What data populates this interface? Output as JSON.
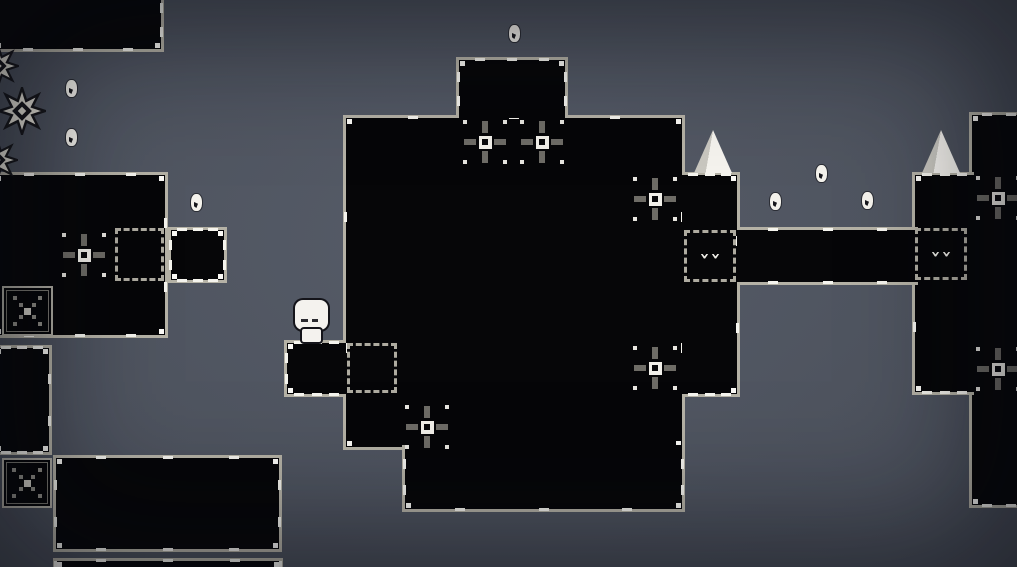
{
  "scene": {
    "width": 1017,
    "height": 567,
    "colors": {
      "background_center": "#565c68",
      "background_edge": "#3b3f49",
      "platform_fill": "#060608",
      "platform_border": "#b5b2a6",
      "tick_white": "#f5f4ee",
      "sprite_white": "#f4f2ec",
      "target_gray": "#6e6c66"
    }
  },
  "entities": {
    "player": {
      "x": 295,
      "y": 300,
      "description": "white blob character with two dark eyes standing on ledge"
    },
    "platforms": [
      {
        "name": "platform-top-left",
        "x": -8,
        "y": -12,
        "w": 172,
        "h": 64,
        "border": "1111"
      },
      {
        "name": "platform-left-mid",
        "x": -8,
        "y": 172,
        "w": 176,
        "h": 166,
        "border": "1111"
      },
      {
        "name": "platform-left-extension",
        "x": 168,
        "y": 227,
        "w": 59,
        "h": 56,
        "border": "1111"
      },
      {
        "name": "platform-left-vertical",
        "x": -8,
        "y": 345,
        "w": 60,
        "h": 110,
        "border": "1111"
      },
      {
        "name": "platform-bottom-left",
        "x": 53,
        "y": 455,
        "w": 229,
        "h": 97,
        "border": "1111"
      },
      {
        "name": "platform-bottom-strip",
        "x": 53,
        "y": 558,
        "w": 230,
        "h": 20,
        "border": "1101"
      },
      {
        "name": "platform-right-big",
        "x": 969,
        "y": 112,
        "w": 80,
        "h": 396,
        "border": "1011"
      },
      {
        "name": "platform-right-extension",
        "x": 912,
        "y": 172,
        "w": 62,
        "h": 223,
        "border": "1011"
      },
      {
        "name": "platform-central-main",
        "x": 343,
        "y": 115,
        "w": 342,
        "h": 335,
        "border": "1111"
      },
      {
        "name": "platform-central-top",
        "x": 456,
        "y": 57,
        "w": 112,
        "h": 61,
        "border": "1101"
      },
      {
        "name": "platform-central-lower",
        "x": 402,
        "y": 445,
        "w": 283,
        "h": 67,
        "border": "0111"
      },
      {
        "name": "platform-central-right-extension",
        "x": 682,
        "y": 172,
        "w": 58,
        "h": 225,
        "border": "1110"
      },
      {
        "name": "platform-character-ledge",
        "x": 284,
        "y": 340,
        "w": 62,
        "h": 57,
        "border": "1011"
      },
      {
        "name": "platform-bridge",
        "x": 737,
        "y": 227,
        "w": 181,
        "h": 58,
        "border": "1010"
      }
    ],
    "dashed_zones": [
      {
        "name": "dashed-zone-left",
        "x": 115,
        "y": 228,
        "w": 49,
        "h": 53,
        "face": false
      },
      {
        "name": "dashed-zone-character",
        "x": 347,
        "y": 343,
        "w": 50,
        "h": 50,
        "face": false
      },
      {
        "name": "dashed-zone-central-right",
        "x": 684,
        "y": 230,
        "w": 52,
        "h": 52,
        "face": true
      },
      {
        "name": "dashed-zone-right",
        "x": 915,
        "y": 228,
        "w": 52,
        "h": 52,
        "face": true
      }
    ],
    "x_boxes": [
      {
        "name": "x-box-upper",
        "x": 2,
        "y": 286,
        "w": 51,
        "h": 50
      },
      {
        "name": "x-box-lower",
        "x": 2,
        "y": 458,
        "w": 50,
        "h": 50
      }
    ],
    "targets": [
      {
        "x": 463,
        "y": 120
      },
      {
        "x": 520,
        "y": 120
      },
      {
        "x": 633,
        "y": 177
      },
      {
        "x": 633,
        "y": 346
      },
      {
        "x": 405,
        "y": 405
      },
      {
        "x": 62,
        "y": 233
      },
      {
        "x": 976,
        "y": 176
      },
      {
        "x": 976,
        "y": 347
      }
    ],
    "collectibles": [
      {
        "x": 509,
        "y": 25
      },
      {
        "x": 66,
        "y": 80
      },
      {
        "x": 66,
        "y": 129
      },
      {
        "x": 191,
        "y": 194
      },
      {
        "x": 770,
        "y": 193
      },
      {
        "x": 816,
        "y": 165
      },
      {
        "x": 862,
        "y": 192
      }
    ],
    "spikes": [
      {
        "x": 694,
        "y": 130
      },
      {
        "x": 922,
        "y": 130
      }
    ],
    "gears": [
      {
        "x": -2,
        "y": 87,
        "s": 48
      },
      {
        "x": -23,
        "y": 45,
        "s": 42
      },
      {
        "x": -24,
        "y": 139,
        "s": 42
      }
    ]
  }
}
